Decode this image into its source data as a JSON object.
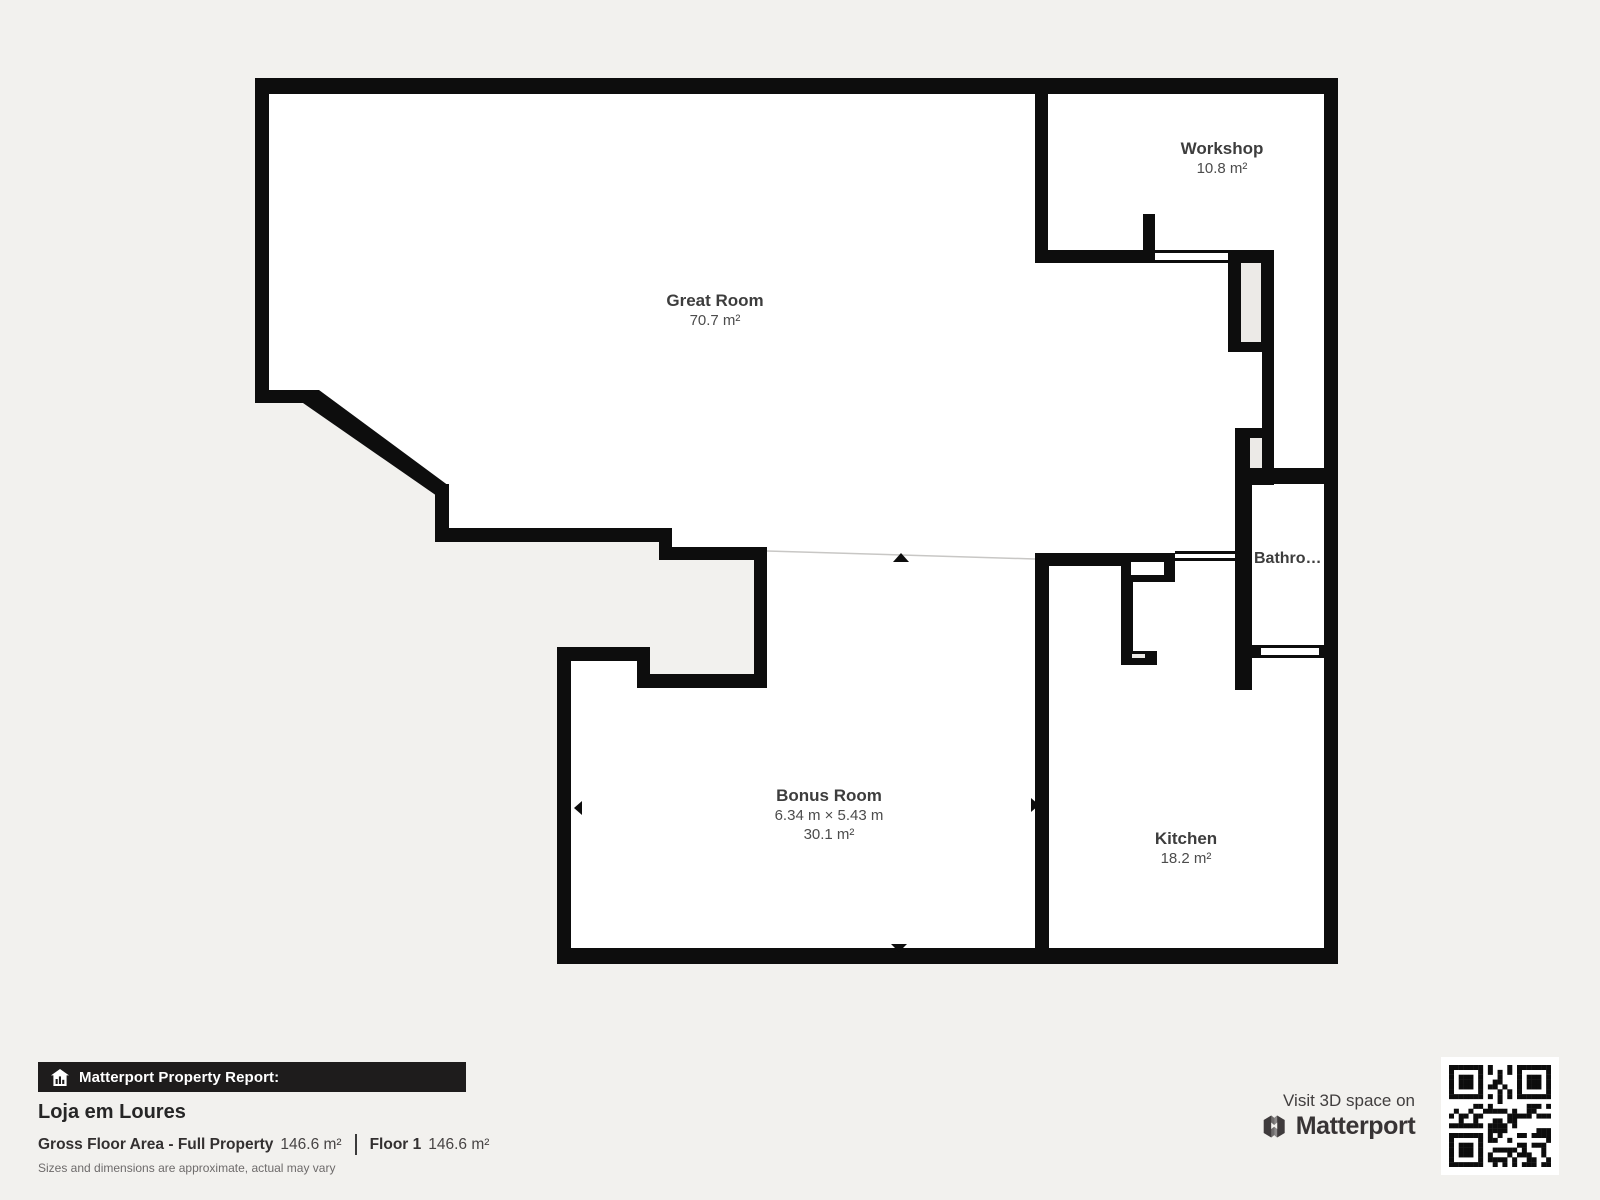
{
  "page": {
    "background": "#f2f1ee",
    "wall_color": "#0d0d0d",
    "floor_color": "#ffffff"
  },
  "floorplan": {
    "rooms": [
      {
        "id": "great-room",
        "name": "Great Room",
        "area": "70.7 m²"
      },
      {
        "id": "workshop",
        "name": "Workshop",
        "area": "10.8 m²"
      },
      {
        "id": "bathroom",
        "name": "Bathro…"
      },
      {
        "id": "bonus-room",
        "name": "Bonus Room",
        "dimensions": "6.34 m × 5.43 m",
        "area": "30.1 m²"
      },
      {
        "id": "kitchen",
        "name": "Kitchen",
        "area": "18.2 m²"
      }
    ]
  },
  "report": {
    "badge": "Matterport Property Report:",
    "property_name": "Loja em Loures",
    "gross_area_label": "Gross Floor Area - Full Property",
    "gross_area_value": "146.6 m²",
    "floor_label": "Floor 1",
    "floor_value": "146.6 m²",
    "disclaimer": "Sizes and dimensions are approximate, actual may vary"
  },
  "promo": {
    "visit_text": "Visit 3D space on",
    "brand": "Matterport"
  }
}
